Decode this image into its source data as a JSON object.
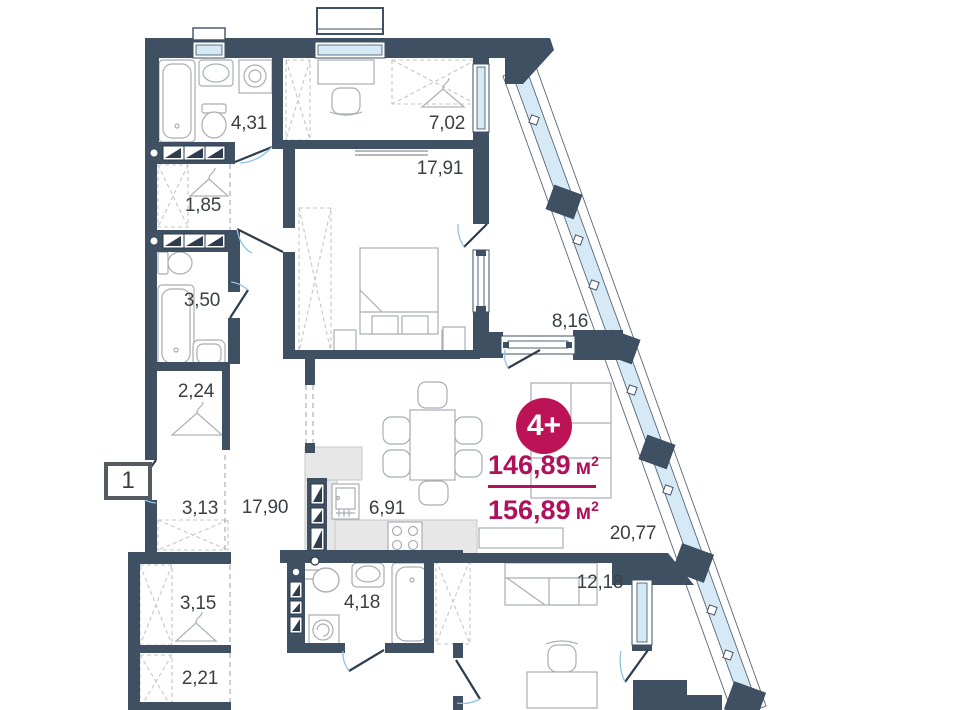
{
  "plan": {
    "unit": {
      "badge": "4+",
      "area_living": "146,89",
      "area_total": "156,89",
      "unit_base": "м",
      "unit_sup": "2"
    },
    "entry_badge": "1",
    "rooms": [
      {
        "name": "bathroom-top",
        "area": "4,31"
      },
      {
        "name": "bedroom-top",
        "area": "7,02"
      },
      {
        "name": "bedroom-master",
        "area": "17,91"
      },
      {
        "name": "wardrobe-1",
        "area": "1,85"
      },
      {
        "name": "bathroom-mid",
        "area": "3,50"
      },
      {
        "name": "wardrobe-2",
        "area": "2,24"
      },
      {
        "name": "balcony",
        "area": "8,16"
      },
      {
        "name": "hall",
        "area": "3,13"
      },
      {
        "name": "corridor",
        "area": "17,90"
      },
      {
        "name": "kitchen",
        "area": "6,91"
      },
      {
        "name": "living-room",
        "area": "20,77"
      },
      {
        "name": "wardrobe-3",
        "area": "3,15"
      },
      {
        "name": "bathroom-bottom",
        "area": "4,18"
      },
      {
        "name": "bedroom-bottom",
        "area": "12,18"
      },
      {
        "name": "wardrobe-4",
        "area": "2,21"
      }
    ],
    "colors": {
      "wall": "#3e5062",
      "window": "#d5e9f6",
      "accent": "#b0115a",
      "label": "#3b4045"
    }
  }
}
